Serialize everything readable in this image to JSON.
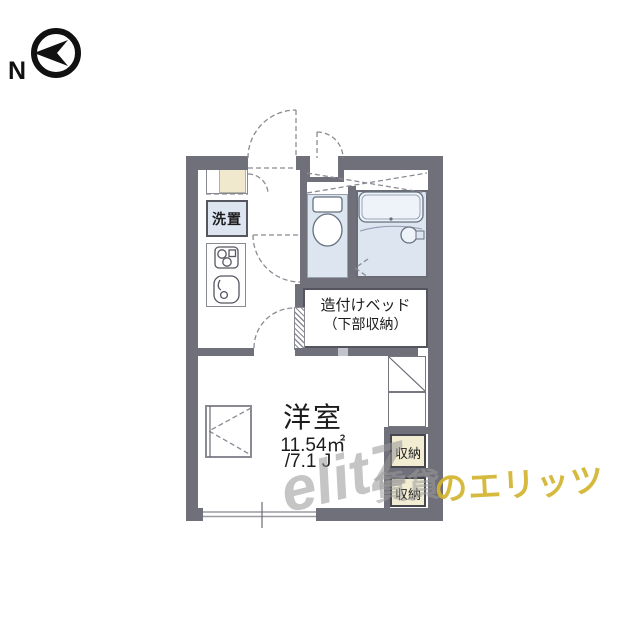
{
  "compass": {
    "label": "N"
  },
  "floor_plan": {
    "labels": {
      "laundry": "洗置",
      "built_in_bed": "造付けベッド",
      "built_in_bed_sub": "（下部収納）",
      "main_room": "洋室",
      "main_room_area_sqm": "11.54㎡",
      "main_room_area_tatami": "/7.1 J",
      "storage_top": "収納",
      "storage_bottom": "収納"
    },
    "colors": {
      "wall": "#70707a",
      "wet_area": "#dde5f1",
      "storage_fill": "#f2ecd2",
      "shoe_cabinet_fill": "#f0e9cd",
      "line": "#8a8a94"
    }
  },
  "watermark": {
    "logo": "elitZ",
    "gray_text": "賃貸",
    "yellow_text": "のエリッツ",
    "yellow_color": "#d2b52f",
    "gray_color": "#9b9b9b"
  }
}
